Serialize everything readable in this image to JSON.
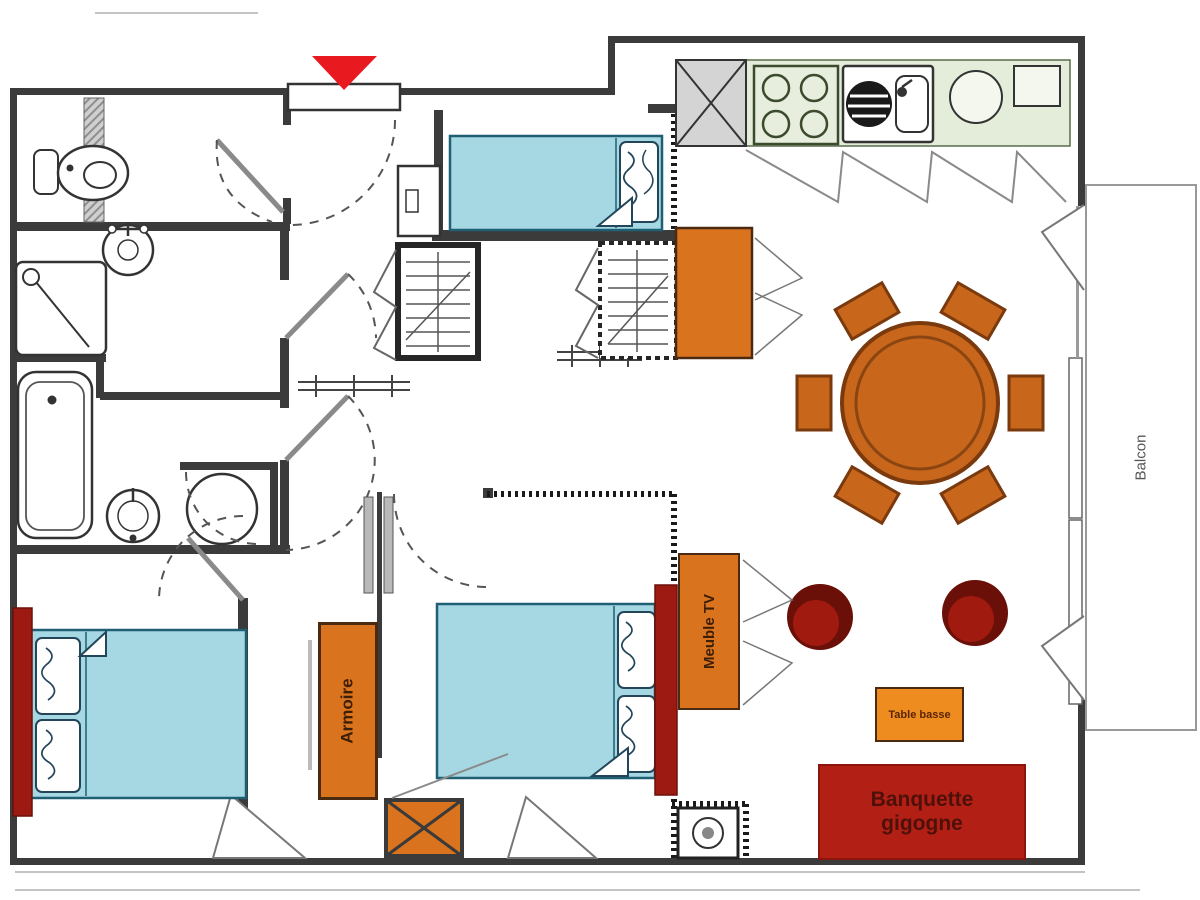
{
  "diagram": {
    "type": "apartment-floor-plan",
    "labels": {
      "armoire": "Armoire",
      "meuble_tv": "Meuble TV",
      "table_basse": "Table basse",
      "banquette": "Banquette gigogne",
      "balcon": "Balcon"
    },
    "colors": {
      "wall_dark": "#3b3b3b",
      "furniture_orange": "#d9731d",
      "dining_table_orange": "#c8671b",
      "coffee_table_orange": "#ef8c1f",
      "sofa_red": "#b22015",
      "armchair_dark_red": "#6b1008",
      "armchair_red": "#a01a10",
      "bed_headboard_red": "#9c1a12",
      "entry_marker_red": "#e8191f",
      "bed_blue": "#a6d8e4",
      "kitchen_green": "#e4edda"
    }
  }
}
